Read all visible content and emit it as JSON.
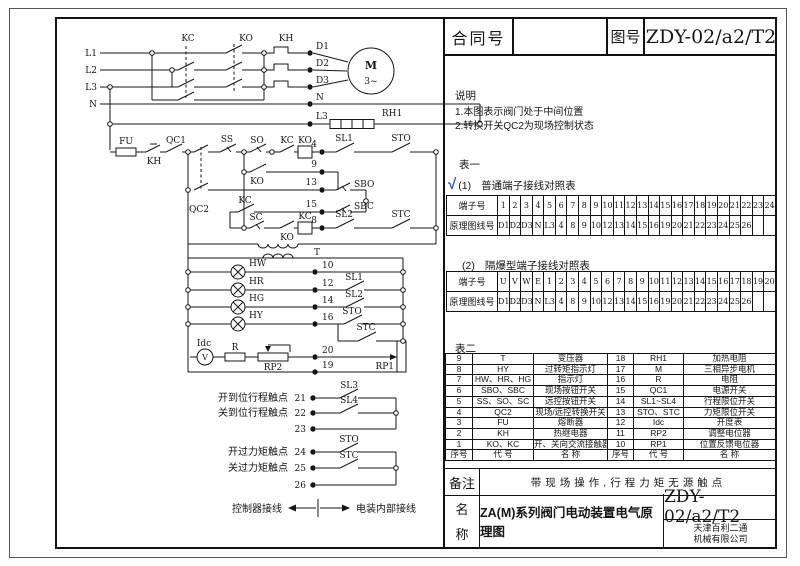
{
  "title_block": {
    "contract_label": "合同号",
    "contract_value": "",
    "drawing_label": "图号",
    "drawing_no": "ZDY-02/a2/T2"
  },
  "notes": {
    "heading": "说明",
    "line1": "1.本图表示阀门处于中间位置",
    "line2": "2.转换开关QC2为现场控制状态"
  },
  "table1": {
    "heading": "表一",
    "check": "√",
    "sub1": "(1)",
    "sub1_title": "普通端子接线对照表",
    "sub2": "(2)",
    "sub2_title": "隔爆型端子接线对照表",
    "row_label_terminal": "端子号",
    "row_label_wire": "原理图线号",
    "t1_terminals": [
      "1",
      "2",
      "3",
      "4",
      "5",
      "6",
      "7",
      "8",
      "9",
      "10",
      "11",
      "12",
      "13",
      "14",
      "15",
      "16",
      "17",
      "18",
      "19",
      "20",
      "21",
      "22",
      "23",
      "24"
    ],
    "t1_wires": [
      "D1",
      "D2",
      "D3",
      "N",
      "L3",
      "4",
      "8",
      "9",
      "10",
      "12",
      "13",
      "14",
      "15",
      "16",
      "19",
      "20",
      "21",
      "22",
      "23",
      "24",
      "25",
      "26",
      "",
      ""
    ],
    "t2_terminals": [
      "U",
      "V",
      "W",
      "E",
      "1",
      "2",
      "3",
      "4",
      "5",
      "6",
      "7",
      "8",
      "9",
      "10",
      "11",
      "12",
      "13",
      "14",
      "15",
      "16",
      "17",
      "18",
      "19",
      "20"
    ],
    "t2_wires": [
      "D1",
      "D2",
      "D3",
      "N",
      "L3",
      "4",
      "8",
      "9",
      "10",
      "12",
      "13",
      "14",
      "15",
      "16",
      "19",
      "20",
      "21",
      "22",
      "23",
      "24",
      "25",
      "26",
      "",
      ""
    ]
  },
  "table2": {
    "heading": "表二",
    "rows": [
      [
        "9",
        "T",
        "变压器",
        "18",
        "RH1",
        "加热电阻"
      ],
      [
        "8",
        "HY",
        "过转矩指示灯",
        "17",
        "M",
        "三相异步电机"
      ],
      [
        "7",
        "HW、HR、HG",
        "指示灯",
        "16",
        "R",
        "电阻"
      ],
      [
        "6",
        "SBO、SBC",
        "现场按钮开关",
        "15",
        "QC1",
        "电源开关"
      ],
      [
        "5",
        "SS、SO、SC",
        "远控按钮开关",
        "14",
        "SL1~SL4",
        "行程限位开关"
      ],
      [
        "4",
        "QC2",
        "现场/远控转换开关",
        "13",
        "STO、STC",
        "力矩限位开关"
      ],
      [
        "3",
        "FU",
        "熔断器",
        "12",
        "Idc",
        "开度表"
      ],
      [
        "2",
        "KH",
        "热继电器",
        "11",
        "RP2",
        "调整电位器"
      ],
      [
        "1",
        "KO、KC",
        "开、关向交流接触器",
        "10",
        "RP1",
        "位置反馈电位器"
      ],
      [
        "序号",
        "代 号",
        "名 称",
        "序号",
        "代 号",
        "名 称"
      ]
    ]
  },
  "remarks": {
    "label": "备注",
    "text": "带现场操作,行程力矩无源触点"
  },
  "name_block": {
    "label_line1": "名",
    "label_line2": "称",
    "title": "ZA(M)系列阀门电动装置电气原理图",
    "drawing_no": "ZDY-02/a2/T2",
    "company_line1": "天津百利二通",
    "company_line2": "机械有限公司"
  },
  "schematic": {
    "labels": {
      "L1": "L1",
      "L2": "L2",
      "L3": "L3",
      "N": "N",
      "KC": "KC",
      "KO": "KO",
      "KH": "KH",
      "D1": "D1",
      "D2": "D2",
      "D3": "D3",
      "M": "M",
      "phase": "3~",
      "RH1": "RH1",
      "FU": "FU",
      "QC1": "QC1",
      "QC2": "QC2",
      "SS": "SS",
      "SO": "SO",
      "SC": "SC",
      "SBO": "SBO",
      "SBC": "SBC",
      "SL1": "SL1",
      "SL2": "SL2",
      "SL3": "SL3",
      "SL4": "SL4",
      "STO": "STO",
      "STC": "STC",
      "T": "T",
      "HW": "HW",
      "HR": "HR",
      "HG": "HG",
      "HY": "HY",
      "Idc": "Idc",
      "V": "V",
      "R": "R",
      "RP1": "RP1",
      "RP2": "RP2",
      "n4": "4",
      "n8": "8",
      "n9": "9",
      "n10": "10",
      "n12": "12",
      "n13": "13",
      "n14": "14",
      "n15": "15",
      "n16": "16",
      "n19": "19",
      "n20": "20",
      "n21": "21",
      "n22": "22",
      "n23": "23",
      "n24": "24",
      "n25": "25",
      "n26": "26"
    },
    "captions": {
      "open_travel": "开到位行程触点",
      "close_travel": "关到位行程触点",
      "open_torque": "开过力矩触点",
      "close_torque": "关过力矩触点",
      "controller_wiring": "控制器接线",
      "internal_wiring": "电装内部接线"
    }
  }
}
